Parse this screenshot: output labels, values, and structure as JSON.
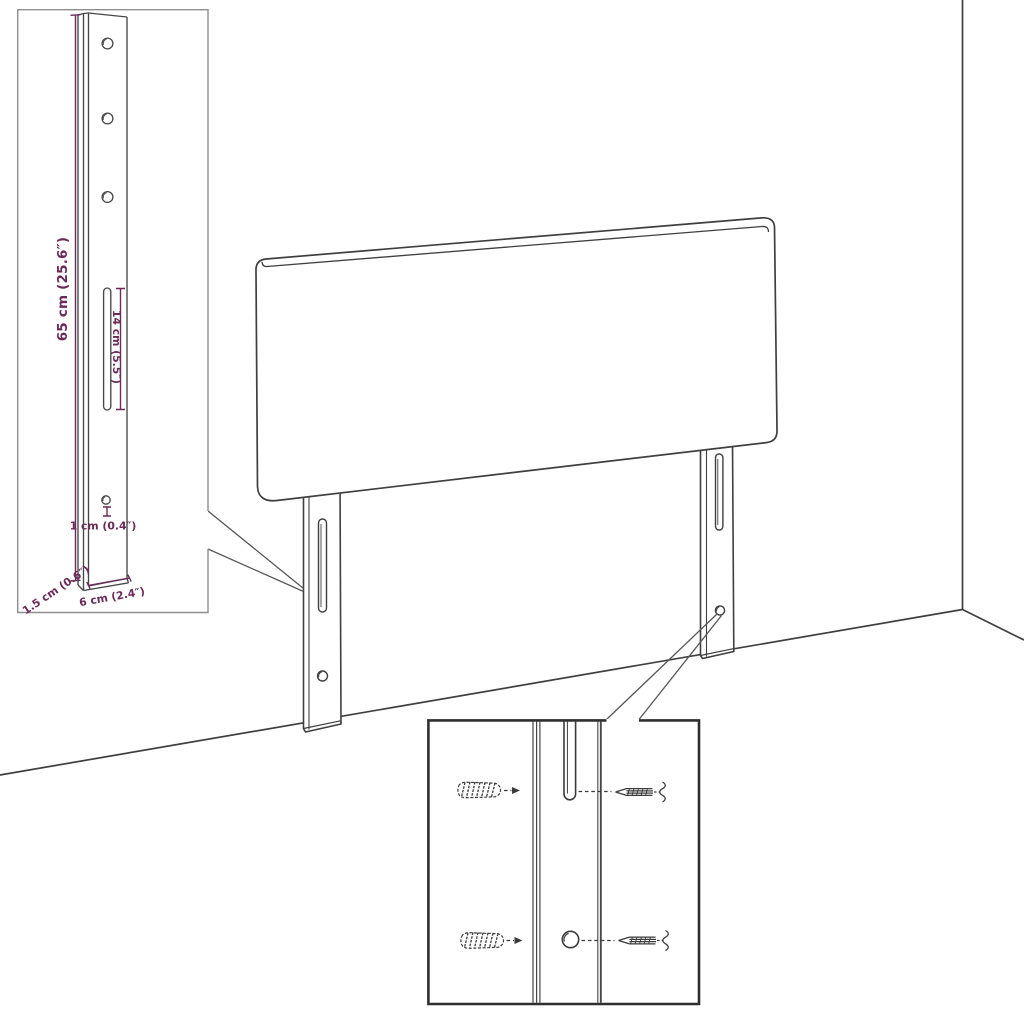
{
  "diagram": {
    "subject": "headboard-assembly-line-drawing",
    "colors": {
      "background": "#ffffff",
      "line_art": "#3f3f3f",
      "dimension_accent": "#6b2a57",
      "inset_border_light": "#8f8f8f",
      "inset_border_dark": "#2f2f2f"
    },
    "leg_detail_inset": {
      "labels": {
        "height": "65 cm (25.6″)",
        "slot_length": "14 cm (5.5″)",
        "hole_diameter": "1 cm (0.4″)",
        "thickness": "1.5 cm (0.6″)",
        "width": "6 cm (2.4″)"
      }
    },
    "hardware_detail_inset": {
      "icons": [
        "wall-plug-icon",
        "screw-icon"
      ]
    }
  }
}
